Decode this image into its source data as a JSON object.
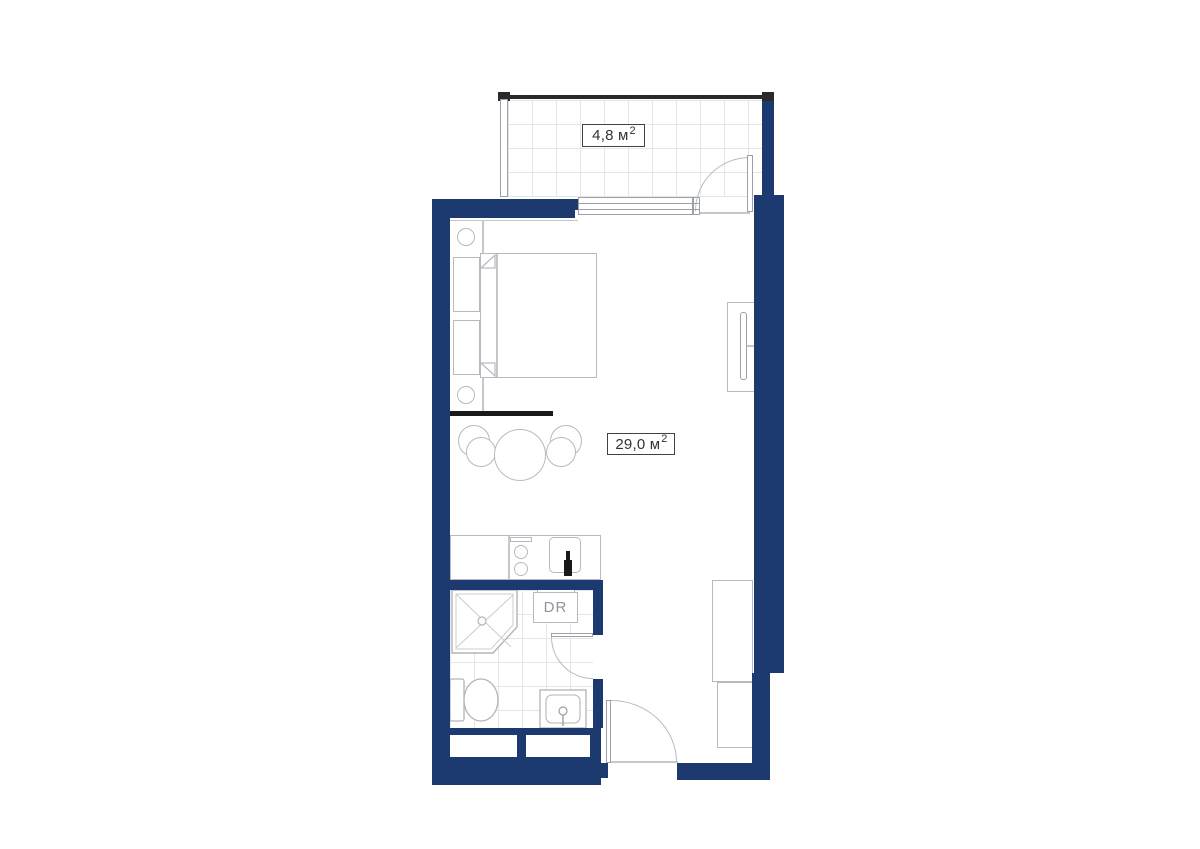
{
  "title": "Studio apartment floor plan",
  "colors": {
    "wall_fill": "#1c3a70",
    "furniture_line": "#b6bac0",
    "grid_line": "#e4e7ea",
    "accent_black": "#1a1a1c",
    "label_text": "#333333",
    "dryer_text": "#8f959b"
  },
  "floorplan": {
    "balcony": {
      "area_value": "4,8 м",
      "area_sup": "2"
    },
    "main_room": {
      "area_value": "29,0 м",
      "area_sup": "2"
    },
    "bathroom": {
      "dryer_label": "DR"
    }
  }
}
